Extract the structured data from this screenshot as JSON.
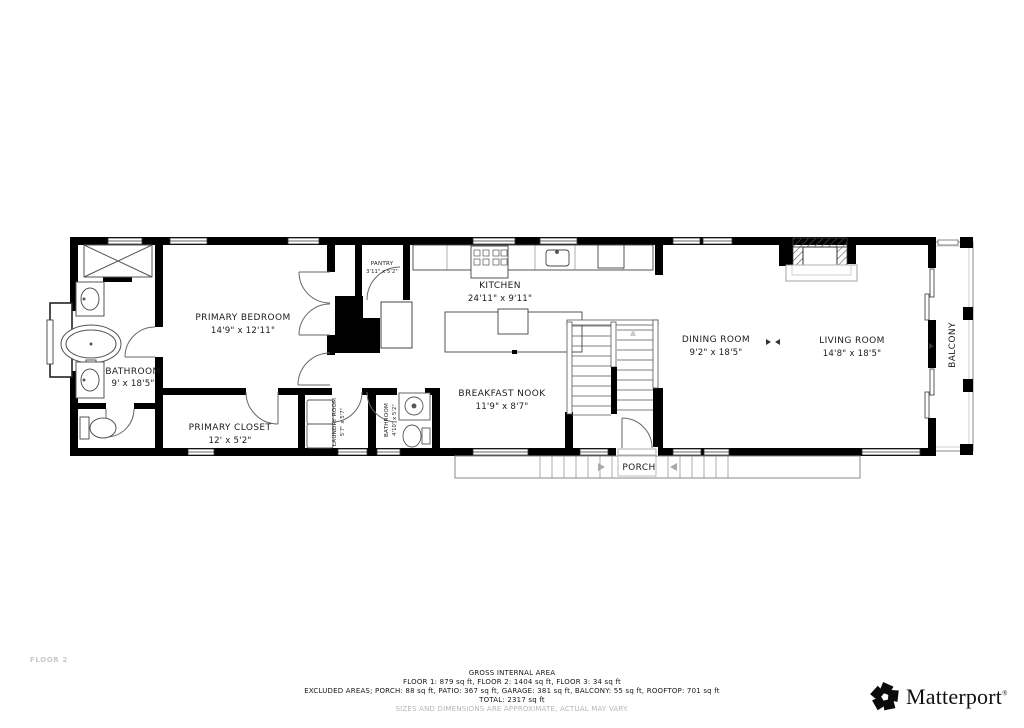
{
  "page": {
    "floor_label": "FLOOR 2"
  },
  "rooms": {
    "primary_bedroom": {
      "name": "PRIMARY BEDROOM",
      "dims": "14'9\" x 12'11\""
    },
    "bathroom": {
      "name": "BATHROOM",
      "dims": "9' x 18'5\""
    },
    "primary_closet": {
      "name": "PRIMARY CLOSET",
      "dims": "12' x 5'2\""
    },
    "pantry": {
      "name": "PANTRY",
      "dims": "3'11\" x 5'2\""
    },
    "kitchen": {
      "name": "KITCHEN",
      "dims": "24'11\" x 9'11\""
    },
    "breakfast_nook": {
      "name": "BREAKFAST NOOK",
      "dims": "11'9\" x 8'7\""
    },
    "laundry_room": {
      "name": "LAUNDRY ROOM",
      "dims": "5'7\" x 5'7\""
    },
    "bathroom_2": {
      "name": "BATHROOM",
      "dims": "4'10\" x 5'2\""
    },
    "dining_room": {
      "name": "DINING ROOM",
      "dims": "9'2\" x 18'5\""
    },
    "living_room": {
      "name": "LIVING ROOM",
      "dims": "14'8\" x 18'5\""
    },
    "balcony": {
      "name": "BALCONY"
    },
    "porch": {
      "name": "PORCH"
    }
  },
  "footer": {
    "title": "GROSS INTERNAL AREA",
    "floors_line": "FLOOR 1: 879 sq ft, FLOOR 2: 1404 sq ft, FLOOR 3: 34 sq ft",
    "excluded_line": "EXCLUDED AREAS; PORCH: 88 sq ft, PATIO: 367 sq ft, GARAGE: 381 sq ft, BALCONY: 55 sq ft, ROOFTOP: 701 sq ft",
    "total_line": "TOTAL: 2317 sq ft",
    "disclaimer": "SIZES AND DIMENSIONS ARE APPROXIMATE, ACTUAL MAY VARY."
  },
  "branding": {
    "logo_text": "Matterport",
    "registered_mark": "®"
  },
  "colors": {
    "wall": "#000000",
    "fixture_line": "#555555",
    "label_text": "#1c1c1c",
    "muted_text": "#b5b5b5"
  }
}
